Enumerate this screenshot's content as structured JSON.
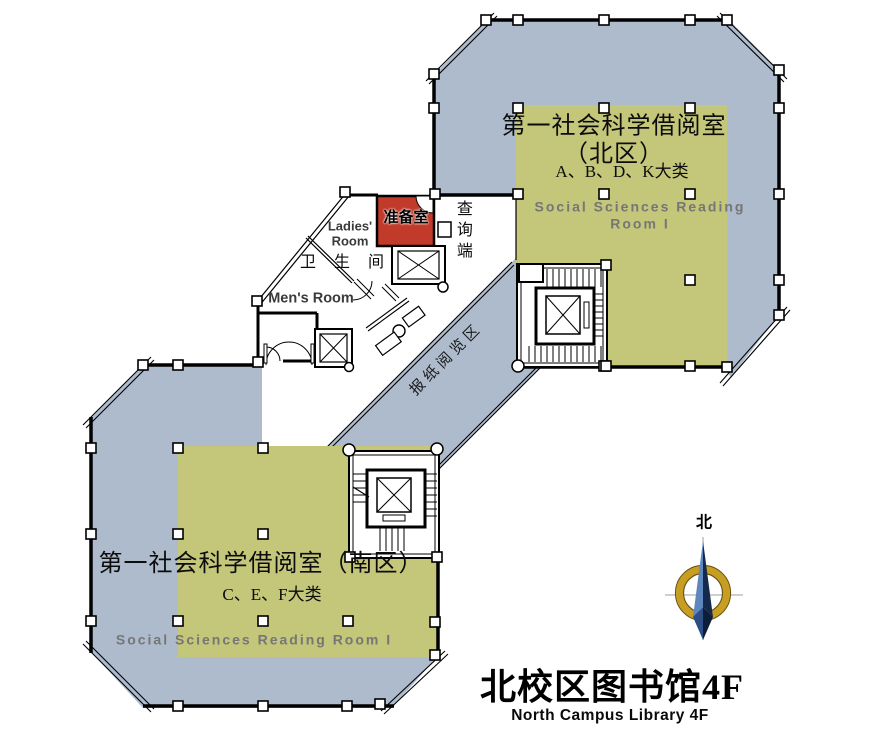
{
  "floor_plan": {
    "title_cn": "北校区图书馆4F",
    "title_en": "North Campus Library 4F"
  },
  "north_wing": {
    "name": "第一社会科学借阅室（北区）",
    "categories": "A、B、D、K大类",
    "name_en": "Social Sciences Reading Room I"
  },
  "south_wing": {
    "name": "第一社会科学借阅室（南区）",
    "categories": "C、E、F大类",
    "name_en": "Social Sciences Reading Room I"
  },
  "corridor": {
    "label": "报纸阅览区"
  },
  "facilities": {
    "prep_room": "准备室",
    "query_terminal": "查询端",
    "restroom": "卫生间",
    "ladies_room": "Ladies'\nRoom",
    "mens_room": "Men's Room"
  },
  "compass": {
    "north": "北"
  },
  "colors": {
    "wing_fill": "#adbbcc",
    "reading_area_fill": "#c4c67a",
    "prep_room_fill": "#c23b2a",
    "subtitle_gray": "#767676",
    "wall": "#000000",
    "compass_gold": "#c79e22",
    "compass_blue_light": "#5d87bd",
    "compass_blue_dark": "#15294d"
  }
}
